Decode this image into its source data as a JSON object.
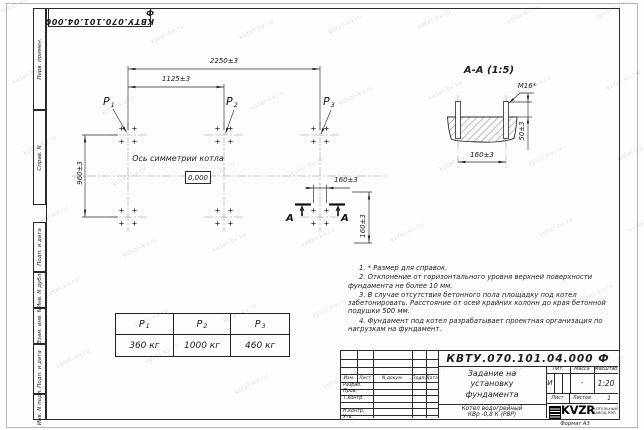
{
  "watermark": {
    "text": "kotel-kv.ru"
  },
  "stamp_top": {
    "number": "КВТУ.070.101.04.000 Ф"
  },
  "sidebar": {
    "labels": [
      "Перв. примен.",
      "Справ. N",
      "Подп. и дата",
      "Инв. N дубл.",
      "Взам. инв. N",
      "Подп. и дата",
      "Инв. N подл."
    ]
  },
  "plan": {
    "dim_width_total": "2250±3",
    "dim_width_half": "1125±3",
    "dim_height": "960±3",
    "dim_bolt_h": "160±3",
    "dim_bolt_v": "160±3",
    "axis_label": "Ось симметрии котла",
    "level_mark": "0,000",
    "section_letter": "А",
    "loads": [
      {
        "main": "P",
        "sub": "1"
      },
      {
        "main": "P",
        "sub": "2"
      },
      {
        "main": "P",
        "sub": "3"
      }
    ]
  },
  "section_view": {
    "title": "А-А (1:5)",
    "bolt_thread": "М16*",
    "dim_protrusion": "50±3",
    "dim_spacing": "160±3"
  },
  "notes": [
    "1. * Размер для справок.",
    "2. Отклонение от горизонтального уровня верхней поверхности фундамента не более 10 мм.",
    "3. В случае отсутствия бетонного пола площадку под котел забетонировать. Расстояние от осей крайних колонн до края бетонной подушки 500 мм.",
    "4. Фундамент под котел разрабатывает проектная организация по нагрузкам на фундамент."
  ],
  "load_table": {
    "columns": [
      {
        "main": "P",
        "sub": "1",
        "value": "360 кг"
      },
      {
        "main": "P",
        "sub": "2",
        "value": "1000 кг"
      },
      {
        "main": "P",
        "sub": "3",
        "value": "460 кг"
      }
    ]
  },
  "title_block": {
    "doc_number": "КВТУ.070.101.04.000  Ф",
    "title_lines": [
      "Задание на",
      "установку",
      "фундамента"
    ],
    "product_lines": [
      "Котел водогрейный",
      "КВр -0,8 К (РВР)"
    ],
    "rev_headers": [
      "Изм.",
      "Лист",
      "N докум.",
      "Подп.",
      "Дата"
    ],
    "sign_rows": [
      "Разраб.",
      "Пров.",
      "Т.контр.",
      "",
      "Н.контр.",
      "Утв."
    ],
    "lit_label": "Лит.",
    "lit_value": "И",
    "mass_label": "Масса",
    "mass_value": "-",
    "scale_label": "Масштаб",
    "scale_value": "1:20",
    "sheet_label": "Лист",
    "sheets_label": "Листов",
    "sheets_value": "1",
    "logo_text": "KVZR",
    "logo_caption_lines": [
      "КОТЕЛЬНЫЙ",
      "ЗАВОД РЭП"
    ],
    "format_label": "Формат А3"
  }
}
